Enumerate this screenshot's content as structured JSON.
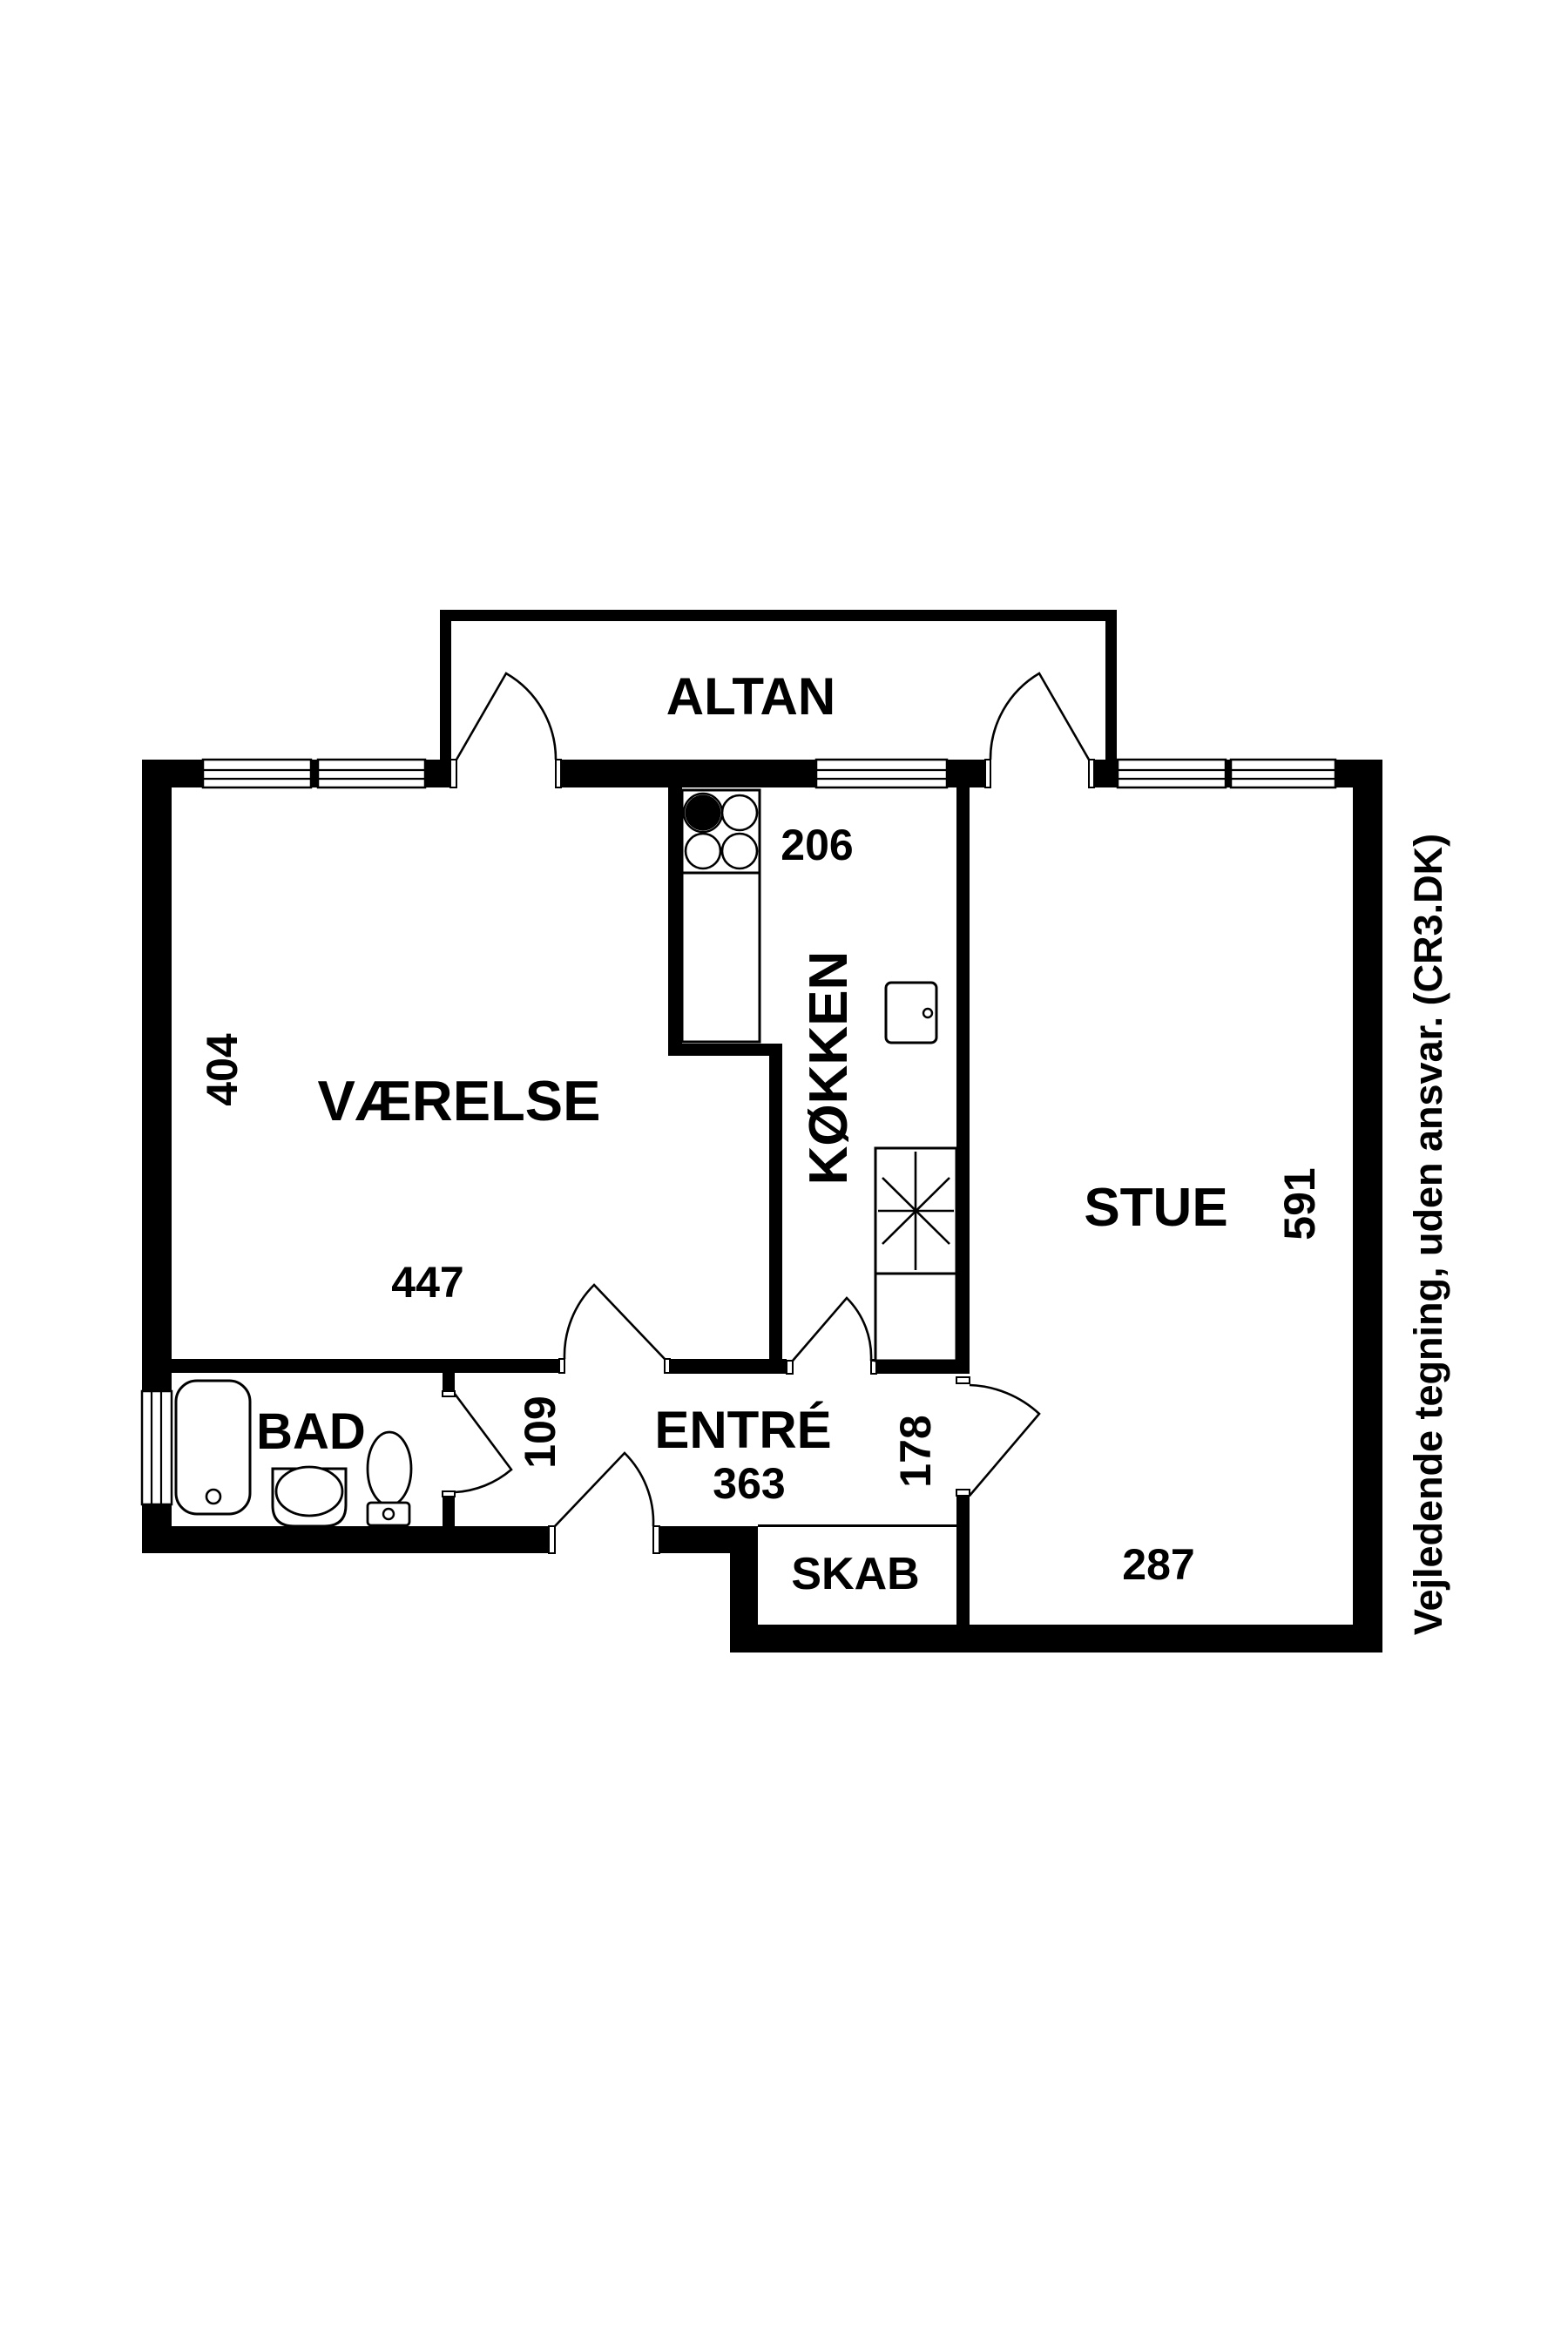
{
  "plan": {
    "rooms": {
      "altan": {
        "label": "ALTAN"
      },
      "vaerelse": {
        "label": "VÆRELSE"
      },
      "koekken": {
        "label": "KØKKEN"
      },
      "stue": {
        "label": "STUE"
      },
      "bad": {
        "label": "BAD"
      },
      "entre": {
        "label": "ENTRÉ"
      },
      "skab": {
        "label": "SKAB"
      }
    },
    "dimensions_cm": {
      "vaerelse_depth": "404",
      "vaerelse_width": "447",
      "koekken_width": "206",
      "stue_depth": "591",
      "stue_width": "287",
      "bad_door": "109",
      "entre_width": "363",
      "entre_depth": "178"
    },
    "footer": {
      "disclaimer": "Vejledende tegning, uden ansvar. (CR3.DK)"
    },
    "colors": {
      "wall": "#000000",
      "background": "#ffffff"
    }
  }
}
